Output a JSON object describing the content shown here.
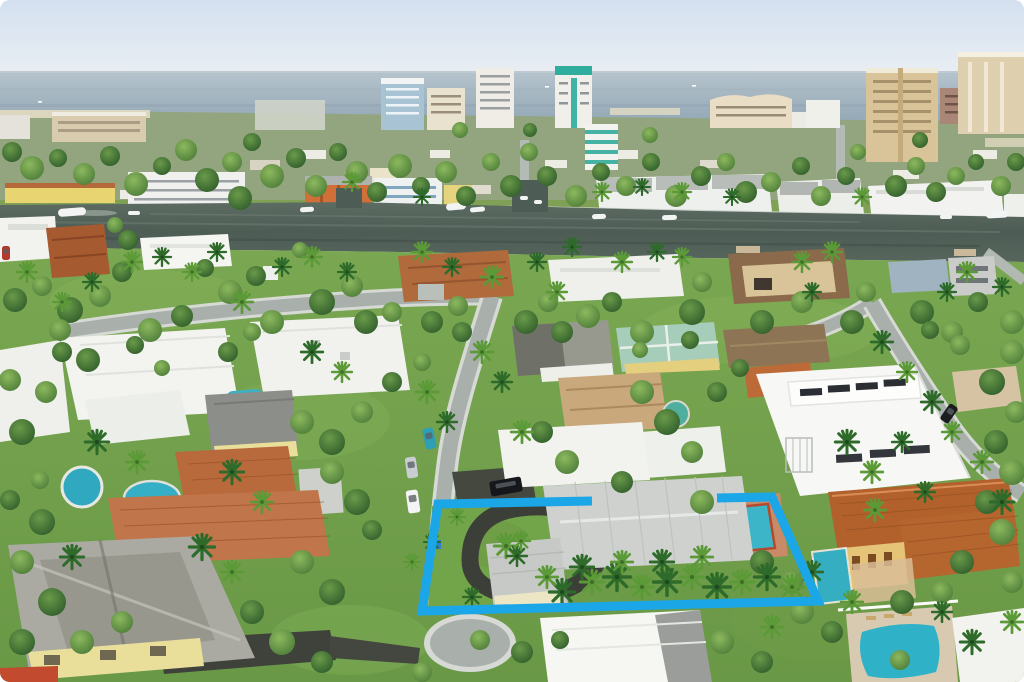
{
  "scene": {
    "type": "aerial-real-estate-photo",
    "description": "Aerial drone photo of a coastal residential neighborhood: ocean horizon and beachfront high-rise condos at top, the Intracoastal Waterway crossing the middle with docked boats, and a suburban grid of homes with white, gray and terracotta roofs, pools and dense palms below. A single-family lot with a circular driveway, gray metal-roof house and backyard pool is outlined with a thick bright blue property boundary.",
    "highlight": {
      "color": "#1ba6e8",
      "stroke_width": 9,
      "polygon_points": [
        [
          438,
          504
        ],
        [
          592,
          501
        ],
        [
          717,
          498
        ],
        [
          772,
          497
        ],
        [
          818,
          601
        ],
        [
          422,
          611
        ]
      ],
      "note": "top edge broken where two-story roof occludes boundary"
    }
  },
  "palette": {
    "sky_top": "#d7e2f0",
    "sky_bottom": "#e9eef3",
    "ocean_top": "#aebfc9",
    "ocean_bottom": "#8ba2b1",
    "waterway": "#53625a",
    "grass": "#6f9c48",
    "street": "#a9b0ab",
    "sidewalk": "#d7dad5",
    "asphalt": "#3c3f38",
    "white_roof": "#f4f5f1",
    "gray_roof": "#ced1ce",
    "dark_roof": "#8b8e89",
    "terracotta_roof": "#b5652e",
    "tan_roof": "#c2a379",
    "teal_roof": "#a6cdb9",
    "pool_water": "#3ab2c6",
    "pool_coping": "#b34a2e",
    "highlight_blue": "#1ba6e8",
    "yellow_wall": "#e7d480"
  },
  "vegetation": {
    "trees": [
      [
        12,
        152,
        10,
        1
      ],
      [
        32,
        168,
        12,
        0
      ],
      [
        58,
        158,
        9,
        1
      ],
      [
        84,
        174,
        11,
        0
      ],
      [
        110,
        156,
        10,
        1
      ],
      [
        136,
        184,
        12,
        0
      ],
      [
        162,
        166,
        9,
        1
      ],
      [
        186,
        150,
        11,
        0
      ],
      [
        207,
        180,
        12,
        1
      ],
      [
        232,
        162,
        10,
        0
      ],
      [
        252,
        142,
        9,
        1
      ],
      [
        272,
        176,
        12,
        0
      ],
      [
        296,
        158,
        10,
        1
      ],
      [
        316,
        186,
        11,
        0
      ],
      [
        338,
        152,
        9,
        1
      ],
      [
        357,
        172,
        11,
        0
      ],
      [
        377,
        192,
        10,
        1
      ],
      [
        400,
        166,
        12,
        0
      ],
      [
        421,
        186,
        9,
        1
      ],
      [
        446,
        172,
        11,
        0
      ],
      [
        466,
        196,
        10,
        1
      ],
      [
        491,
        162,
        9,
        0
      ],
      [
        511,
        186,
        11,
        1
      ],
      [
        529,
        152,
        9,
        0
      ],
      [
        547,
        176,
        10,
        1
      ],
      [
        576,
        196,
        11,
        0
      ],
      [
        601,
        172,
        9,
        1
      ],
      [
        626,
        186,
        10,
        0
      ],
      [
        651,
        162,
        9,
        1
      ],
      [
        676,
        196,
        11,
        0
      ],
      [
        701,
        176,
        10,
        1
      ],
      [
        726,
        162,
        9,
        0
      ],
      [
        746,
        192,
        11,
        1
      ],
      [
        771,
        182,
        10,
        0
      ],
      [
        801,
        166,
        9,
        1
      ],
      [
        821,
        196,
        10,
        0
      ],
      [
        846,
        176,
        9,
        1
      ],
      [
        858,
        152,
        8,
        0
      ],
      [
        896,
        186,
        11,
        1
      ],
      [
        916,
        166,
        9,
        0
      ],
      [
        936,
        192,
        10,
        1
      ],
      [
        956,
        176,
        9,
        0
      ],
      [
        976,
        162,
        8,
        1
      ],
      [
        1001,
        186,
        10,
        0
      ],
      [
        1016,
        162,
        9,
        1
      ],
      [
        240,
        198,
        12,
        1
      ],
      [
        460,
        130,
        8,
        0
      ],
      [
        530,
        130,
        7,
        1
      ],
      [
        650,
        135,
        8,
        0
      ],
      [
        920,
        140,
        8,
        1
      ],
      [
        15,
        300,
        12,
        1
      ],
      [
        42,
        286,
        10,
        0
      ],
      [
        70,
        310,
        13,
        1
      ],
      [
        100,
        296,
        11,
        0
      ],
      [
        122,
        272,
        10,
        1
      ],
      [
        150,
        330,
        12,
        0
      ],
      [
        182,
        316,
        11,
        1
      ],
      [
        230,
        292,
        12,
        0
      ],
      [
        256,
        276,
        10,
        1
      ],
      [
        272,
        322,
        12,
        0
      ],
      [
        322,
        302,
        13,
        1
      ],
      [
        352,
        286,
        11,
        0
      ],
      [
        366,
        322,
        12,
        1
      ],
      [
        392,
        312,
        10,
        0
      ],
      [
        432,
        322,
        11,
        1
      ],
      [
        458,
        306,
        10,
        0
      ],
      [
        526,
        322,
        12,
        1
      ],
      [
        548,
        302,
        10,
        0
      ],
      [
        562,
        332,
        11,
        1
      ],
      [
        588,
        316,
        12,
        0
      ],
      [
        612,
        302,
        10,
        1
      ],
      [
        642,
        332,
        12,
        0
      ],
      [
        692,
        312,
        13,
        1
      ],
      [
        702,
        282,
        10,
        0
      ],
      [
        762,
        322,
        12,
        1
      ],
      [
        802,
        302,
        11,
        0
      ],
      [
        852,
        322,
        12,
        1
      ],
      [
        866,
        292,
        10,
        0
      ],
      [
        922,
        312,
        12,
        1
      ],
      [
        952,
        332,
        11,
        0
      ],
      [
        978,
        302,
        10,
        1
      ],
      [
        1012,
        322,
        12,
        0
      ],
      [
        205,
        268,
        9,
        1
      ],
      [
        300,
        250,
        8,
        0
      ],
      [
        128,
        240,
        10,
        1
      ],
      [
        115,
        225,
        8,
        0
      ],
      [
        22,
        432,
        13,
        1
      ],
      [
        46,
        392,
        11,
        0
      ],
      [
        62,
        352,
        10,
        1
      ],
      [
        302,
        422,
        12,
        0
      ],
      [
        332,
        442,
        13,
        1
      ],
      [
        362,
        412,
        11,
        0
      ],
      [
        392,
        382,
        10,
        1
      ],
      [
        422,
        362,
        9,
        0
      ],
      [
        462,
        332,
        10,
        1
      ],
      [
        332,
        472,
        12,
        0
      ],
      [
        357,
        502,
        13,
        1
      ],
      [
        302,
        562,
        12,
        0
      ],
      [
        332,
        592,
        13,
        1
      ],
      [
        642,
        392,
        12,
        0
      ],
      [
        667,
        422,
        13,
        1
      ],
      [
        692,
        452,
        11,
        0
      ],
      [
        717,
        392,
        10,
        1
      ],
      [
        702,
        502,
        12,
        0
      ],
      [
        542,
        432,
        11,
        1
      ],
      [
        567,
        462,
        12,
        0
      ],
      [
        622,
        482,
        11,
        1
      ],
      [
        1012,
        352,
        12,
        0
      ],
      [
        992,
        382,
        13,
        1
      ],
      [
        1016,
        412,
        11,
        0
      ],
      [
        996,
        442,
        12,
        1
      ],
      [
        1012,
        472,
        13,
        0
      ],
      [
        987,
        502,
        12,
        1
      ],
      [
        1002,
        532,
        13,
        0
      ],
      [
        962,
        562,
        12,
        1
      ],
      [
        1012,
        582,
        11,
        0
      ],
      [
        42,
        522,
        13,
        1
      ],
      [
        22,
        562,
        12,
        0
      ],
      [
        52,
        602,
        14,
        1
      ],
      [
        82,
        642,
        12,
        0
      ],
      [
        22,
        642,
        13,
        1
      ],
      [
        122,
        622,
        11,
        0
      ],
      [
        252,
        612,
        12,
        1
      ],
      [
        282,
        642,
        13,
        0
      ],
      [
        322,
        662,
        11,
        1
      ],
      [
        422,
        672,
        10,
        0
      ],
      [
        522,
        652,
        11,
        1
      ],
      [
        722,
        642,
        12,
        0
      ],
      [
        762,
        662,
        11,
        1
      ],
      [
        802,
        612,
        12,
        0
      ],
      [
        832,
        632,
        11,
        1
      ],
      [
        902,
        602,
        12,
        1
      ],
      [
        942,
        592,
        11,
        0
      ],
      [
        762,
        562,
        12,
        1
      ],
      [
        792,
        582,
        11,
        0
      ],
      [
        372,
        530,
        10,
        1
      ],
      [
        252,
        332,
        9,
        0
      ],
      [
        228,
        352,
        10,
        1
      ],
      [
        60,
        330,
        11,
        0
      ],
      [
        88,
        360,
        12,
        1
      ],
      [
        10,
        380,
        11,
        0
      ],
      [
        135,
        345,
        9,
        1
      ],
      [
        162,
        368,
        8,
        0
      ],
      [
        740,
        368,
        9,
        1
      ],
      [
        640,
        350,
        8,
        0
      ],
      [
        690,
        340,
        9,
        1
      ],
      [
        960,
        345,
        10,
        0
      ],
      [
        930,
        330,
        9,
        1
      ],
      [
        480,
        640,
        10,
        0
      ],
      [
        560,
        640,
        9,
        1
      ],
      [
        900,
        660,
        10,
        0
      ],
      [
        40,
        480,
        9,
        0
      ],
      [
        10,
        500,
        10,
        1
      ]
    ],
    "palms": [
      [
        352,
        182,
        1,
        0
      ],
      [
        422,
        197,
        0.9,
        1
      ],
      [
        602,
        192,
        1,
        0
      ],
      [
        642,
        187,
        0.9,
        1
      ],
      [
        682,
        192,
        1,
        0
      ],
      [
        732,
        197,
        0.9,
        1
      ],
      [
        862,
        197,
        1,
        0
      ],
      [
        27,
        272,
        1.1,
        0
      ],
      [
        92,
        282,
        1,
        1
      ],
      [
        132,
        262,
        1.1,
        0
      ],
      [
        217,
        252,
        1,
        1
      ],
      [
        242,
        302,
        1.2,
        0
      ],
      [
        282,
        267,
        1,
        1
      ],
      [
        312,
        257,
        1.1,
        0
      ],
      [
        347,
        272,
        1,
        1
      ],
      [
        422,
        252,
        1.1,
        0
      ],
      [
        452,
        267,
        1,
        1
      ],
      [
        492,
        277,
        1.2,
        0
      ],
      [
        537,
        262,
        1,
        1
      ],
      [
        557,
        292,
        1.1,
        0
      ],
      [
        572,
        247,
        1,
        1
      ],
      [
        622,
        262,
        1.1,
        0
      ],
      [
        657,
        252,
        1,
        1
      ],
      [
        802,
        262,
        1.1,
        0
      ],
      [
        812,
        292,
        1,
        1
      ],
      [
        832,
        252,
        1.1,
        0
      ],
      [
        947,
        292,
        1,
        1
      ],
      [
        967,
        272,
        1.1,
        0
      ],
      [
        1002,
        287,
        1,
        1
      ],
      [
        682,
        257,
        1,
        0
      ],
      [
        162,
        257,
        1,
        1
      ],
      [
        192,
        272,
        1,
        0
      ],
      [
        62,
        302,
        1,
        0
      ],
      [
        312,
        352,
        1.2,
        1
      ],
      [
        342,
        372,
        1.1,
        0
      ],
      [
        97,
        442,
        1.3,
        1
      ],
      [
        137,
        462,
        1.2,
        0
      ],
      [
        232,
        472,
        1.3,
        1
      ],
      [
        262,
        502,
        1.2,
        0
      ],
      [
        202,
        547,
        1.4,
        1
      ],
      [
        232,
        572,
        1.2,
        0
      ],
      [
        72,
        557,
        1.3,
        1
      ],
      [
        427,
        392,
        1.2,
        0
      ],
      [
        447,
        422,
        1.1,
        1
      ],
      [
        482,
        352,
        1.2,
        0
      ],
      [
        502,
        382,
        1.1,
        1
      ],
      [
        522,
        432,
        1.2,
        0
      ],
      [
        882,
        342,
        1.2,
        1
      ],
      [
        907,
        372,
        1.1,
        0
      ],
      [
        932,
        402,
        1.2,
        1
      ],
      [
        952,
        432,
        1.1,
        0
      ],
      [
        847,
        442,
        1.3,
        1
      ],
      [
        872,
        472,
        1.2,
        0
      ],
      [
        902,
        442,
        1.1,
        1
      ],
      [
        982,
        462,
        1.2,
        0
      ],
      [
        1002,
        502,
        1.3,
        1
      ],
      [
        506,
        546,
        1.3,
        0
      ],
      [
        517,
        556,
        1.1,
        1
      ],
      [
        521,
        541,
        1,
        0
      ],
      [
        562,
        592,
        1.4,
        1
      ],
      [
        592,
        582,
        1.3,
        0
      ],
      [
        617,
        577,
        1.5,
        1
      ],
      [
        642,
        587,
        1.3,
        0
      ],
      [
        667,
        582,
        1.5,
        1
      ],
      [
        692,
        577,
        1.3,
        0
      ],
      [
        717,
        587,
        1.5,
        1
      ],
      [
        742,
        582,
        1.3,
        0
      ],
      [
        767,
        577,
        1.4,
        1
      ],
      [
        792,
        587,
        1.3,
        0
      ],
      [
        812,
        572,
        1.2,
        1
      ],
      [
        702,
        557,
        1.2,
        0
      ],
      [
        662,
        562,
        1.3,
        1
      ],
      [
        622,
        562,
        1.2,
        0
      ],
      [
        582,
        567,
        1.3,
        1
      ],
      [
        547,
        577,
        1.2,
        0
      ],
      [
        1012,
        622,
        1.2,
        0
      ],
      [
        972,
        642,
        1.3,
        1
      ],
      [
        875,
        510,
        1.2,
        0
      ],
      [
        925,
        492,
        1.1,
        1
      ],
      [
        852,
        602,
        1.2,
        0
      ],
      [
        942,
        612,
        1.1,
        1
      ],
      [
        772,
        627,
        1.2,
        0
      ],
      [
        432,
        542,
        0.9,
        1
      ],
      [
        457,
        517,
        0.9,
        0
      ],
      [
        472,
        597,
        1,
        1
      ],
      [
        412,
        562,
        0.9,
        0
      ]
    ]
  },
  "boats": [
    [
      58,
      208,
      28,
      8,
      -4
    ],
    [
      128,
      211,
      12,
      4,
      0
    ],
    [
      300,
      207,
      14,
      5,
      -3
    ],
    [
      446,
      203,
      20,
      7,
      -5
    ],
    [
      470,
      207,
      15,
      5,
      -5
    ],
    [
      592,
      214,
      14,
      5,
      -2
    ],
    [
      662,
      215,
      15,
      5,
      -2
    ],
    [
      940,
      215,
      12,
      4,
      0
    ],
    [
      986,
      211,
      22,
      7,
      -3
    ],
    [
      520,
      196,
      8,
      4,
      0
    ],
    [
      534,
      200,
      8,
      4,
      0
    ]
  ],
  "ocean_boats": [
    [
      545,
      86
    ],
    [
      692,
      85
    ],
    [
      38,
      101
    ],
    [
      760,
      95
    ]
  ],
  "cars": [
    [
      424,
      428,
      11,
      21,
      -12,
      "#2f9fb6"
    ],
    [
      406,
      457,
      11,
      21,
      -8,
      "#c9ccd0"
    ],
    [
      407,
      490,
      12,
      23,
      -8,
      "#f3f4f3"
    ],
    [
      490,
      479,
      32,
      15,
      -10,
      "#15171b"
    ],
    [
      944,
      404,
      10,
      19,
      35,
      "#1a1c20"
    ],
    [
      2,
      246,
      8,
      14,
      0,
      "#b03a30"
    ]
  ]
}
